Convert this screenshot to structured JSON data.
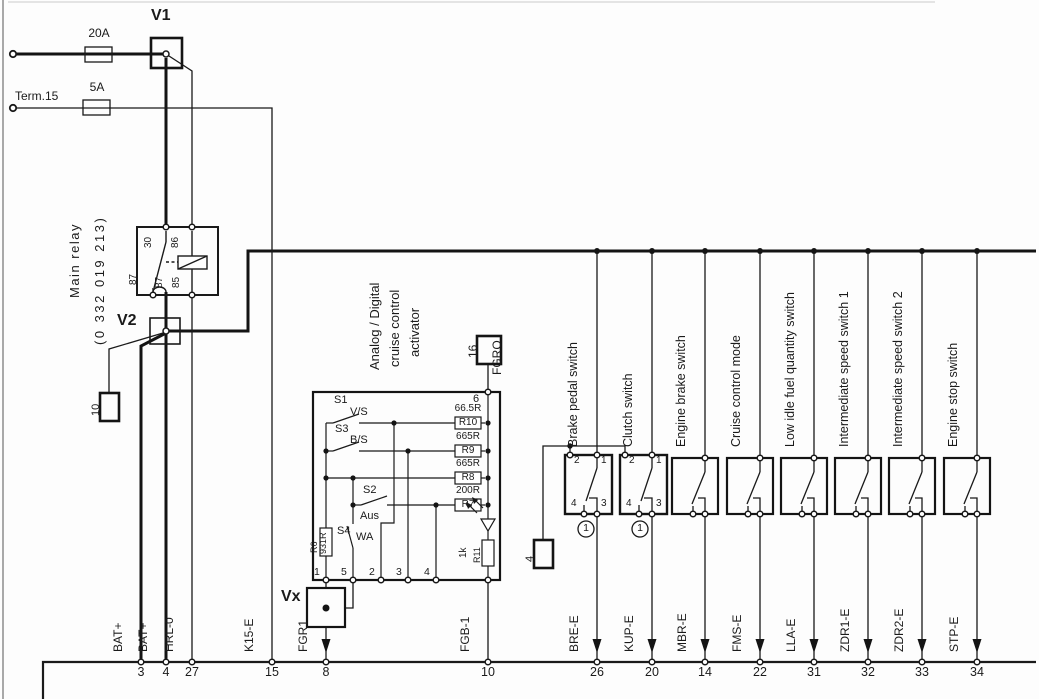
{
  "power": {
    "battery_fuse": "20A",
    "ignition_fuse": "5A",
    "term15_label": "Term.15",
    "v1": "V1",
    "v2": "V2",
    "vx": "Vx",
    "connector10": "10"
  },
  "relay": {
    "name": "Main relay",
    "part_number": "(0 332 019 213)",
    "pins": {
      "p30": "30",
      "p86": "86",
      "p87a": "87",
      "p87b": "87",
      "p85": "85"
    }
  },
  "activator": {
    "title_line1": "Analog / Digital",
    "title_line2": "cruise control",
    "title_line3": "activator",
    "pin6": "6",
    "connector16": "16",
    "fgro": "FGRO",
    "s1": "S1",
    "s1_mode": "V/S",
    "s3": "S3",
    "s3_mode": "B/S",
    "s2": "S2",
    "s2_mode": "Aus",
    "s4": "S4",
    "s4_mode": "WA",
    "r10_value": "66.5R",
    "r10": "R10",
    "r9_value": "665R",
    "r9": "R9",
    "r8_value": "665R",
    "r8": "R8",
    "r7_value": "200R",
    "r7": "R7",
    "r6": "R6",
    "r6_value": "931R",
    "r11": "R11",
    "r11_value": "1k",
    "pins": [
      "1",
      "5",
      "2",
      "3",
      "4"
    ]
  },
  "switch_bank": {
    "connector4": "4",
    "badge_brake": "1",
    "badge_clutch": "1",
    "boxes": [
      {
        "label": "Brake pedal switch",
        "pin_top_left": "2",
        "pin_top_right": "1",
        "pin_bottom_left": "4",
        "pin_bottom_right": "3"
      },
      {
        "label": "Clutch switch",
        "pin_top_left": "2",
        "pin_top_right": "1",
        "pin_bottom_left": "4",
        "pin_bottom_right": "3"
      },
      {
        "label": "Engine brake switch"
      },
      {
        "label": "Cruise control mode"
      },
      {
        "label": "Low idle fuel quantity switch"
      },
      {
        "label": "Intermediate speed switch 1"
      },
      {
        "label": "Intermediate speed switch 2"
      },
      {
        "label": "Engine stop switch"
      }
    ]
  },
  "ecu_bus": {
    "pins": [
      {
        "signal": "BAT+",
        "number": "3"
      },
      {
        "signal": "BAT+",
        "number": "4"
      },
      {
        "signal": "HRL-0",
        "number": "27"
      },
      {
        "signal": "K15-E",
        "number": "15"
      },
      {
        "signal": "FGR1",
        "number": "8"
      },
      {
        "signal": "FGB-1",
        "number": "10"
      },
      {
        "signal": "BRE-E",
        "number": "26"
      },
      {
        "signal": "KUP-E",
        "number": "20"
      },
      {
        "signal": "MBR-E",
        "number": "14"
      },
      {
        "signal": "FMS-E",
        "number": "22"
      },
      {
        "signal": "LLA-E",
        "number": "31"
      },
      {
        "signal": "ZDR1-E",
        "number": "32"
      },
      {
        "signal": "ZDR2-E",
        "number": "33"
      },
      {
        "signal": "STP-E",
        "number": "34"
      }
    ]
  }
}
